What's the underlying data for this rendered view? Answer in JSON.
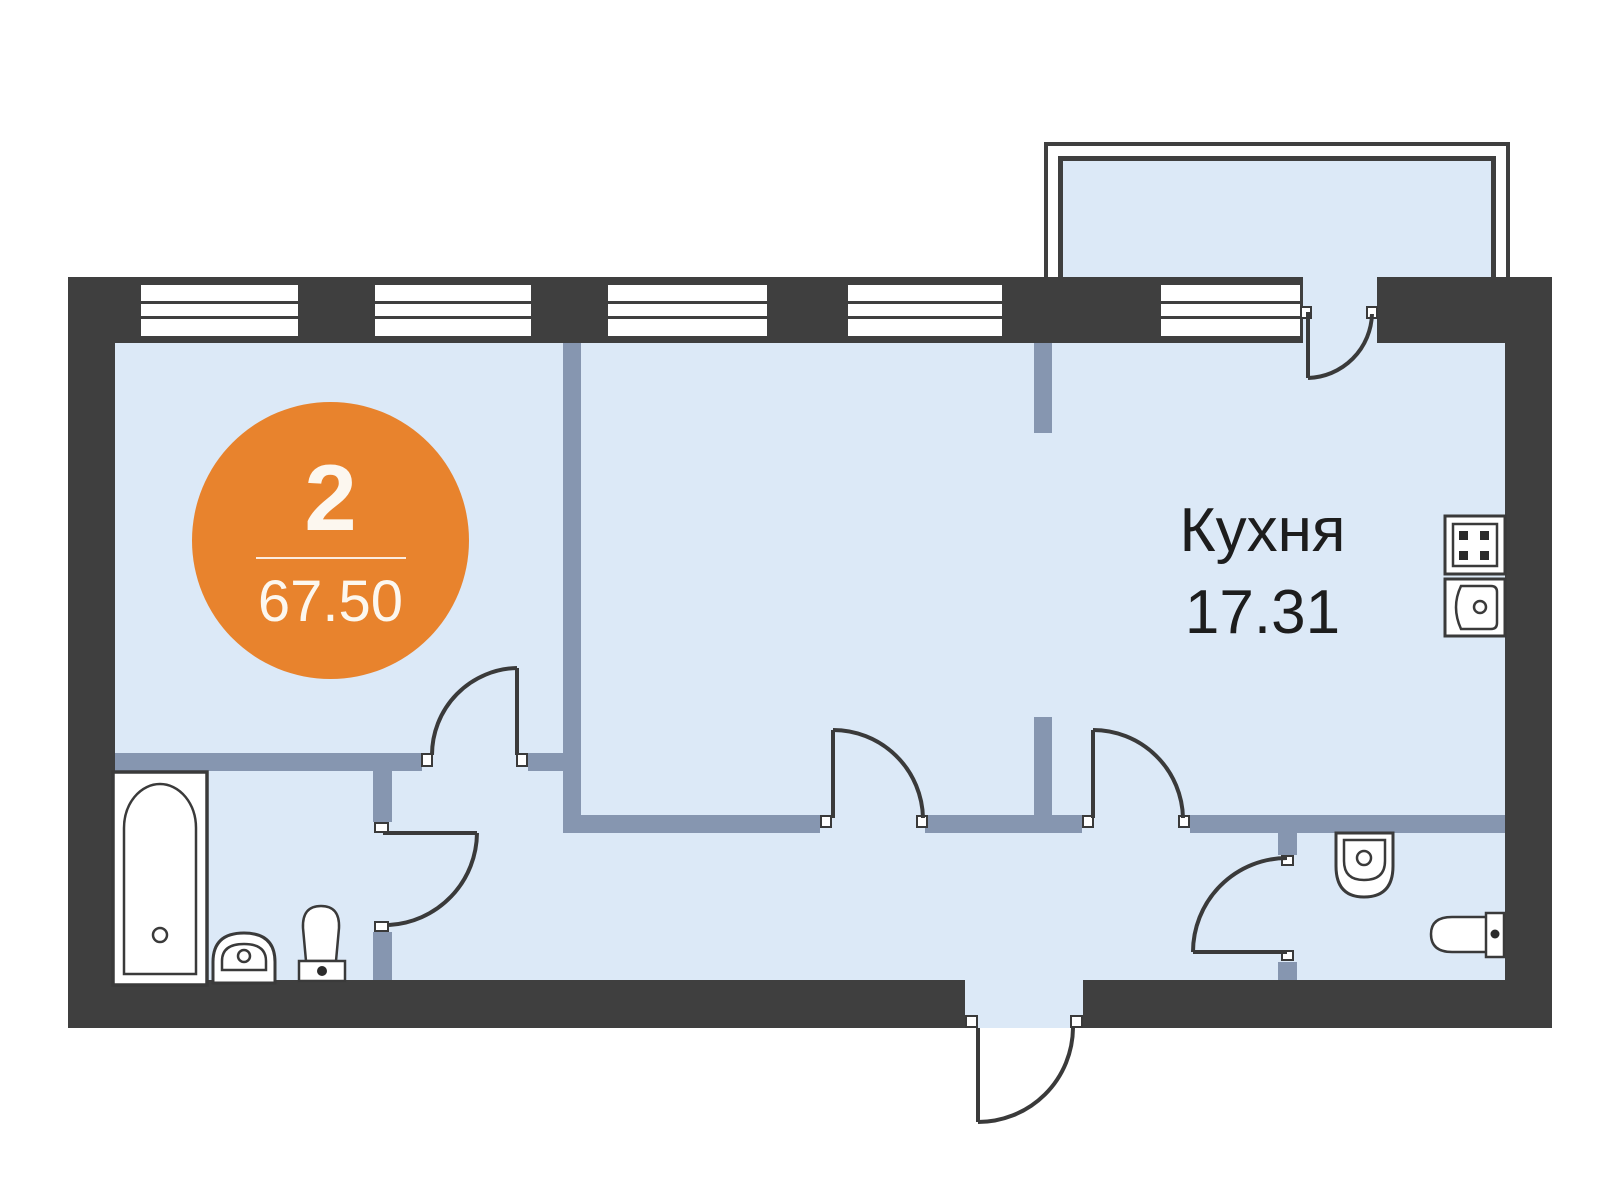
{
  "floorplan": {
    "badge": {
      "rooms": "2",
      "total_area": "67.50"
    },
    "rooms": [
      {
        "name": "Кухня",
        "area": "17.31"
      }
    ],
    "fixtures": [
      "bathtub",
      "pedestal-sink",
      "toilet-left",
      "wall-sink",
      "toilet-right",
      "stove",
      "kitchen-sink"
    ]
  },
  "colors": {
    "wall_dark": "#3F3F3F",
    "wall_inner": "#8696B0",
    "floor": "#DCE9F7",
    "accent": "#E8832D",
    "line": "#3A3A3A",
    "label": "#1D1D1D"
  }
}
